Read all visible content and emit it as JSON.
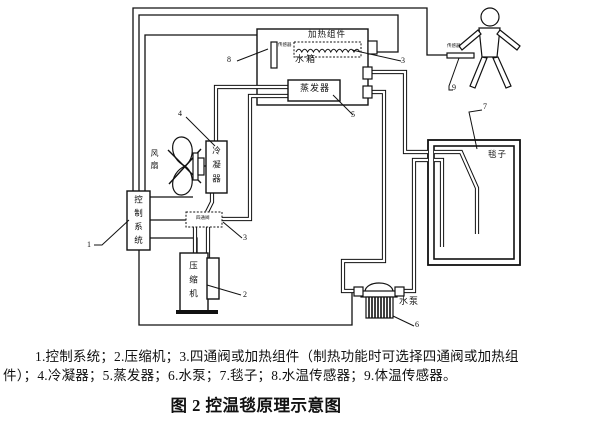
{
  "diagram": {
    "components": {
      "control_system": "控制系统",
      "compressor": "压缩机",
      "four_way_valve": "四通阀",
      "condenser": "冷凝器",
      "fan": "风扇",
      "water_tank": "水箱",
      "heating_unit": "加热组件",
      "evaporator": "蒸发器",
      "water_pump": "水泵",
      "blanket": "毯子",
      "water_temp_sensor": "传感器",
      "body_temp_sensor": "传感器"
    },
    "callouts": {
      "n1": "1",
      "n2": "2",
      "n3_top": "3",
      "n3_bottom": "3",
      "n4": "4",
      "n5": "5",
      "n6": "6",
      "n7": "7",
      "n8": "8",
      "n9": "9"
    }
  },
  "caption": {
    "line1": "1.控制系统；2.压缩机；3.四通阀或加热组件（制热功能时可选择四通阀或加热组",
    "line2": "件）；4.冷凝器；5.蒸发器；6.水泵；7.毯子；8.水温传感器；9.体温传感器。",
    "title": "图 2 控温毯原理示意图"
  },
  "colors": {
    "ink": "#111111",
    "background": "#ffffff"
  }
}
